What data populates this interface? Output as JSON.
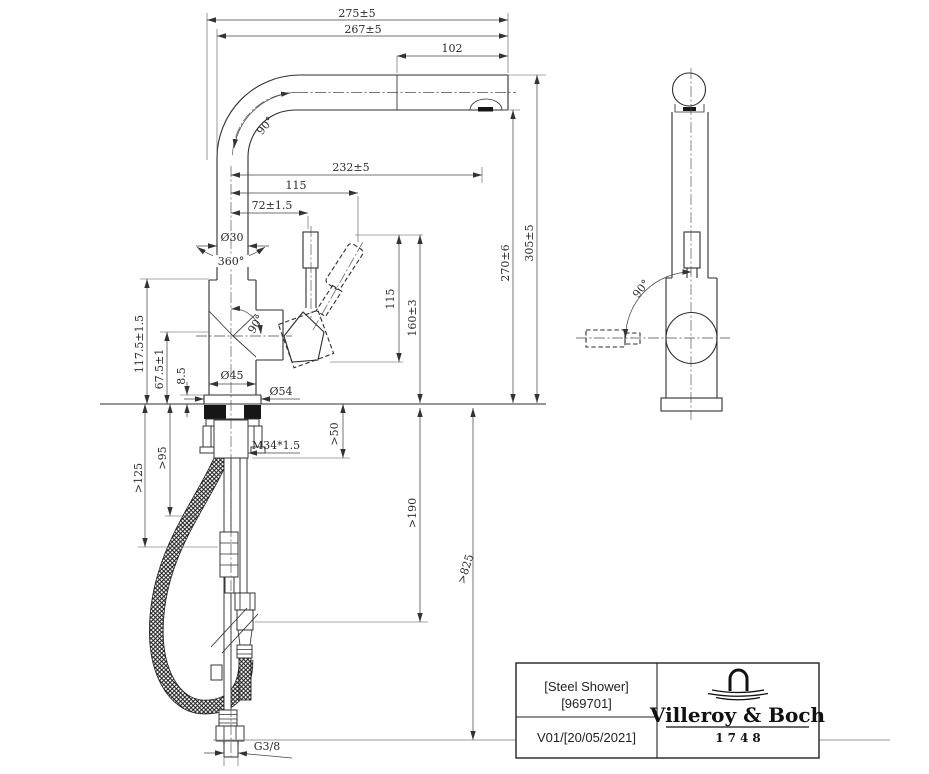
{
  "dimensions": {
    "overall_projection": "275±5",
    "spout_projection": "267±5",
    "spray_head_length": "102",
    "spout_bend_angle": "90°",
    "spout_reach": "232±5",
    "handle_tip_offset": "115",
    "handle_axis_offset": "72±1.5",
    "spout_tube_diameter": "Ø30",
    "swivel_range": "360°",
    "handle_swing_angle_front": "90°",
    "handle_vertical_span": "115",
    "handle_top_height": "160±3",
    "spout_underside_height": "270±6",
    "overall_height": "305±5",
    "body_height": "117.5±1.5",
    "handle_axis_height": "67.5±1",
    "base_ring_height": "8.5",
    "body_diameter": "Ø45",
    "base_diameter": "Ø54",
    "shank_thread": "M34*1.5",
    "deck_clearance": ">50",
    "clearance_95": ">95",
    "clearance_125": ">125",
    "connection_length": ">190",
    "hose_length": ">825",
    "supply_thread": "G3/8",
    "handle_swing_angle_side": "90°"
  },
  "title_block": {
    "product_name": "[Steel Shower]",
    "article_number": "[969701]",
    "version_date": "V01/[20/05/2021]",
    "brand": "Villeroy & Boch",
    "brand_year": "1748"
  }
}
